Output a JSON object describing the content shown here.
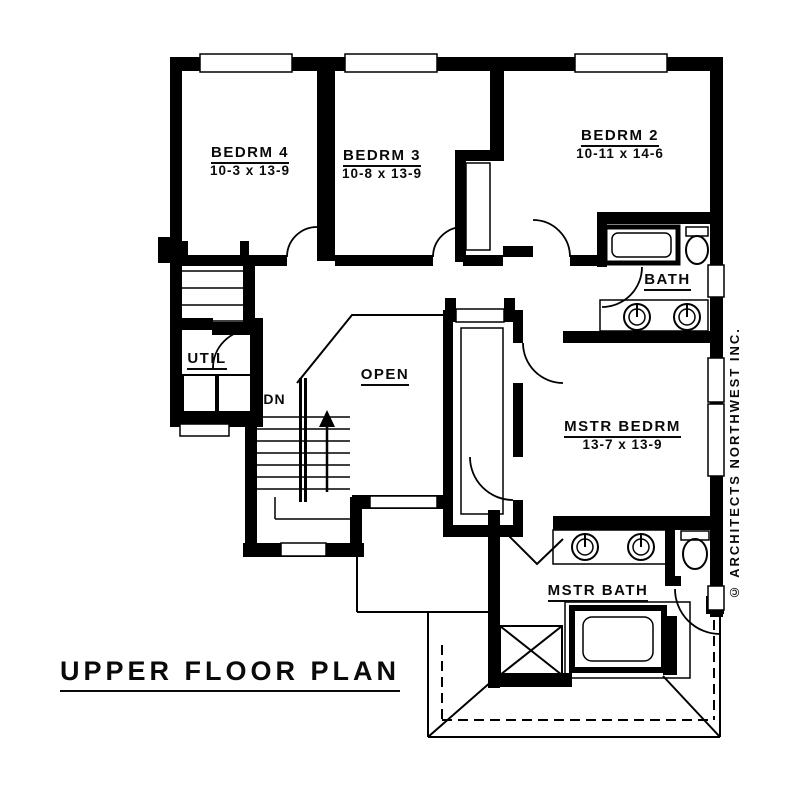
{
  "plan": {
    "title": "UPPER FLOOR PLAN",
    "copyright": "© ARCHITECTS NORTHWEST INC.",
    "colors": {
      "line": "#000000",
      "background": "#ffffff"
    },
    "rooms": [
      {
        "id": "bedrm4",
        "name": "BEDRM 4",
        "dims": "10-3 x 13-9"
      },
      {
        "id": "bedrm3",
        "name": "BEDRM 3",
        "dims": "10-8 x 13-9"
      },
      {
        "id": "bedrm2",
        "name": "BEDRM 2",
        "dims": "10-11 x 14-6"
      },
      {
        "id": "bath",
        "name": "BATH",
        "dims": ""
      },
      {
        "id": "util",
        "name": "UTIL",
        "dims": ""
      },
      {
        "id": "open",
        "name": "OPEN",
        "dims": ""
      },
      {
        "id": "mstr-bedrm",
        "name": "MSTR BEDRM",
        "dims": "13-7 x 13-9"
      },
      {
        "id": "mstr-bath",
        "name": "MSTR BATH",
        "dims": ""
      }
    ],
    "annotations": {
      "down": "DN"
    }
  }
}
